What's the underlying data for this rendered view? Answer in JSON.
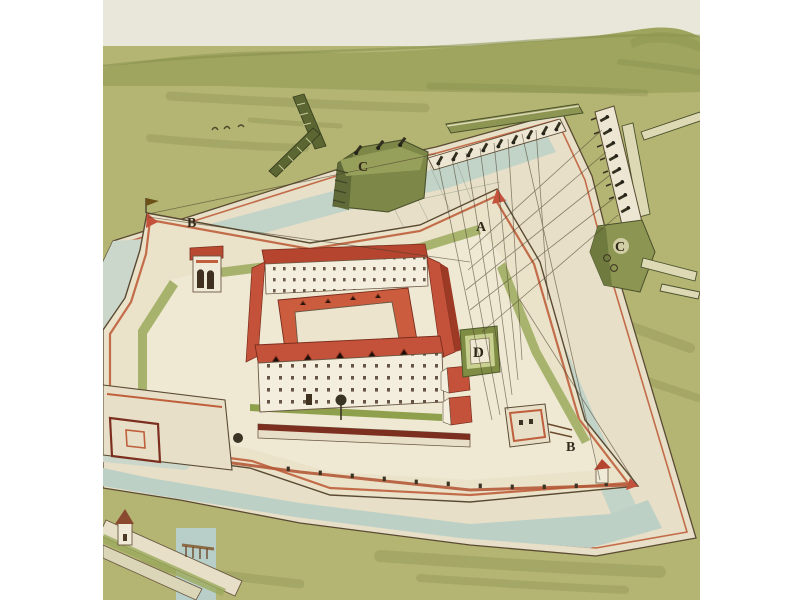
{
  "scene": {
    "description": "Hand-drawn bird's-eye watercolor view of a four-bastioned star fortress with a central quadrangle citadel, moat, covered way, outworks, and besieging gun batteries with fire trajectory lines",
    "labels": {
      "bastion_a": "A",
      "bastion_b_west": "B",
      "bastion_b_southeast": "B",
      "battery_c_north": "C",
      "battery_c_east": "C",
      "cavalier_d": "D"
    },
    "palette": {
      "paper_margin": "#ffffff",
      "sky": "#e9e7da",
      "hills": "#9fa55f",
      "field": "#b4b573",
      "field_shade": "#7d8645",
      "moat_water": "#c2d3c8",
      "wall_cream": "#e7dfc7",
      "wall_white": "#f3eedd",
      "red_trim": "#bf5f3c",
      "roof_red": "#c4513a",
      "parapet_maroon": "#7d2f1f",
      "battery_olive": "#7c8748",
      "ink_outline": "#5a4a33",
      "label_ink": "#342a1b"
    }
  }
}
